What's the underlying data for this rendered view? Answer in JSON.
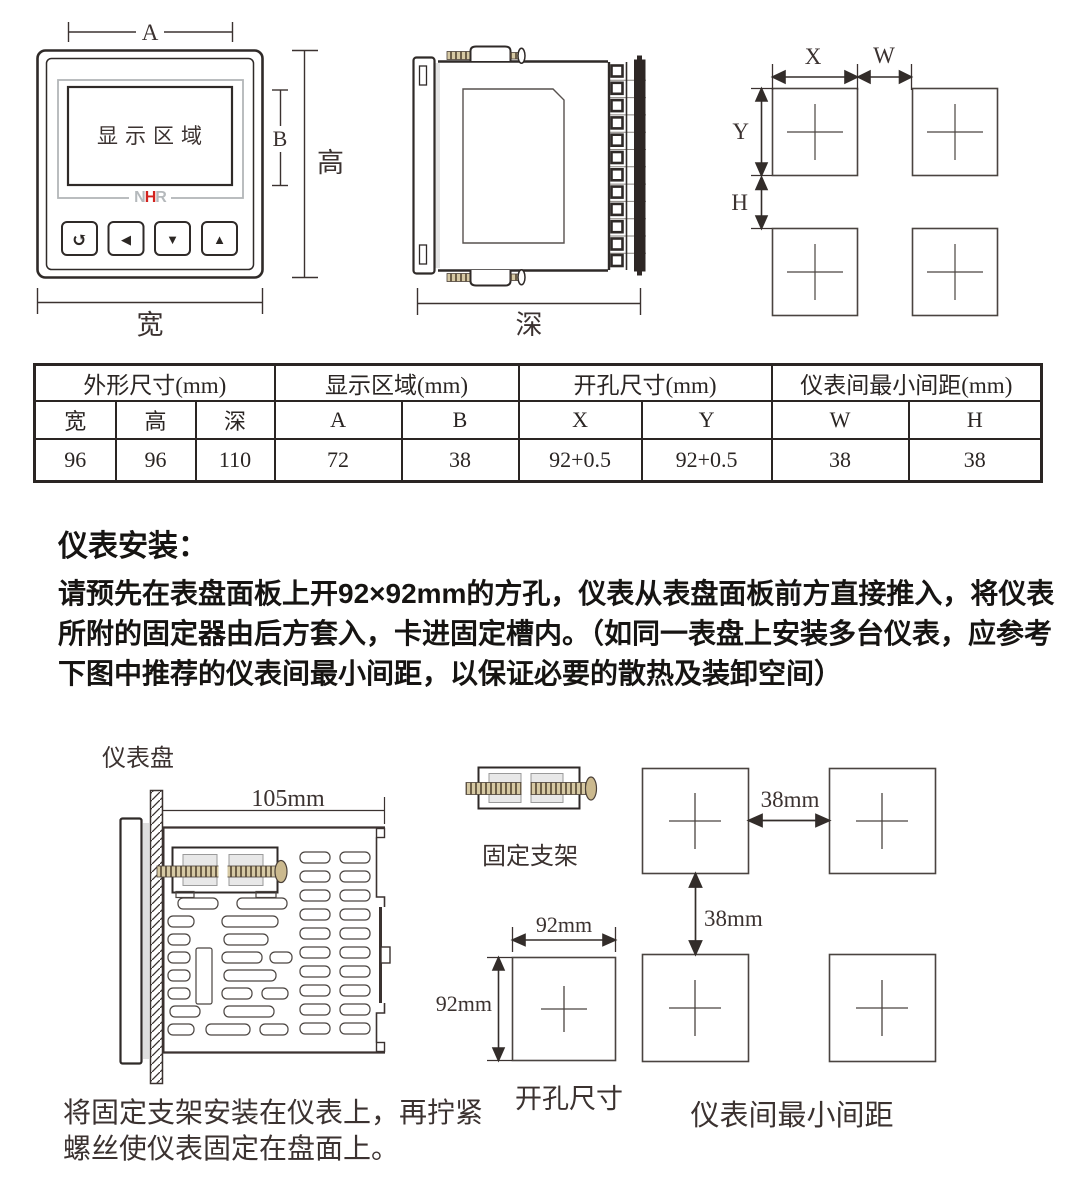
{
  "colors": {
    "line": "#3b3230",
    "logo_red": "#d2231f",
    "logo_gray": "#b5b9bc",
    "terminal_dark": "#2e2725",
    "screw_tan": "#cbb98e"
  },
  "figures": {
    "front_view": {
      "dim_a_label": "A",
      "dim_b_label": "B",
      "height_label": "高",
      "width_label": "宽",
      "display_label": "显示区域",
      "logo_n": "N",
      "logo_h": "H",
      "logo_r": "R",
      "btn_return": "↺",
      "btn_left": "◀",
      "btn_down": "▼",
      "btn_up": "▲"
    },
    "side_view": {
      "depth_label": "深"
    },
    "cutout_diagram": {
      "x_label": "X",
      "w_label": "W",
      "y_label": "Y",
      "h_label": "H"
    }
  },
  "table": {
    "groups": [
      "外形尺寸(mm)",
      "显示区域(mm)",
      "开孔尺寸(mm)",
      "仪表间最小间距(mm)"
    ],
    "columns": [
      "宽",
      "高",
      "深",
      "A",
      "B",
      "X",
      "Y",
      "W",
      "H"
    ],
    "values": [
      "96",
      "96",
      "110",
      "72",
      "38",
      "92+0.5",
      "92+0.5",
      "38",
      "38"
    ]
  },
  "installation": {
    "heading": "仪表安装：",
    "body_lines": [
      "请预先在表盘面板上开92×92mm的方孔，仪表从表盘面板前方直接推入，将仪表",
      "所附的固定器由后方套入，卡进固定槽内。（如同一表盘上安装多台仪表，应参考",
      "下图中推荐的仪表间最小间距，以保证必要的散热及装卸空间）"
    ]
  },
  "bottom": {
    "panel_label": "仪表盘",
    "dim_105": "105mm",
    "bracket_label": "固定支架",
    "cutout_square": {
      "dim_top": "92mm",
      "dim_left": "92mm",
      "caption": "开孔尺寸"
    },
    "spacing": {
      "dim_horizontal": "38mm",
      "dim_vertical": "38mm",
      "caption": "仪表间最小间距"
    },
    "note_lines": [
      "将固定支架安装在仪表上，再拧紧",
      "螺丝使仪表固定在盘面上。"
    ]
  }
}
